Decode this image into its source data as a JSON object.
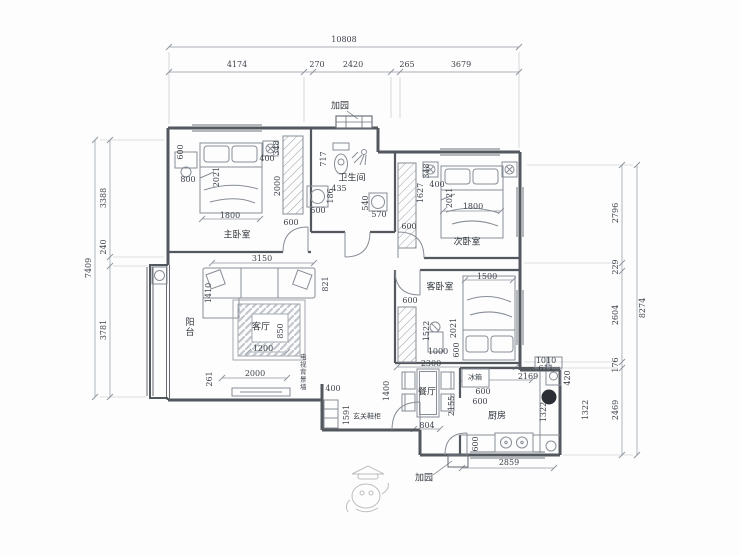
{
  "plan": {
    "title_hint": "apartment floor plan drawing",
    "colors": {
      "wall": "#53585f",
      "furniture": "#878d96",
      "dimension": "#9097a0",
      "text": "#3f444c",
      "bg": "#fdfdfd"
    },
    "outer_dims": {
      "top": {
        "total": "10808",
        "segments": [
          "4174",
          "270",
          "2420",
          "265",
          "3679"
        ]
      },
      "left": {
        "total": "7409",
        "segments": [
          "3388",
          "240",
          "3781"
        ]
      },
      "right": {
        "total": "8274",
        "segments": [
          "2796",
          "229",
          "2604",
          "176",
          "2469"
        ]
      }
    },
    "rooms": {
      "master_bedroom": "主卧室",
      "second_bedroom": "次卧室",
      "guest_bedroom": "客卧室",
      "living_room": "客厅",
      "bathroom": "卫生间",
      "dining_room": "餐厅",
      "kitchen": "厨房",
      "balcony": "阳台"
    },
    "annotations": {
      "tv_wall": "电视背景墙",
      "entry_cabinet": "玄关鞋柜",
      "fridge": "冰箱",
      "garden_top": "加园",
      "garden_bottom": "加园"
    },
    "interior_dims": [
      "600",
      "800",
      "2021",
      "1800",
      "400",
      "348",
      "2000",
      "600",
      "717",
      "435",
      "500",
      "186",
      "540",
      "570",
      "348",
      "1627",
      "400",
      "600",
      "2021",
      "1800",
      "1500",
      "600",
      "1522",
      "1000",
      "2021",
      "600",
      "2300",
      "3150",
      "1410",
      "821",
      "850",
      "1200",
      "2000",
      "261",
      "400",
      "1591",
      "1400",
      "2155",
      "804",
      "1010",
      "611",
      "2169",
      "420",
      "600",
      "600",
      "1322",
      "1322",
      "600",
      "2859"
    ]
  }
}
